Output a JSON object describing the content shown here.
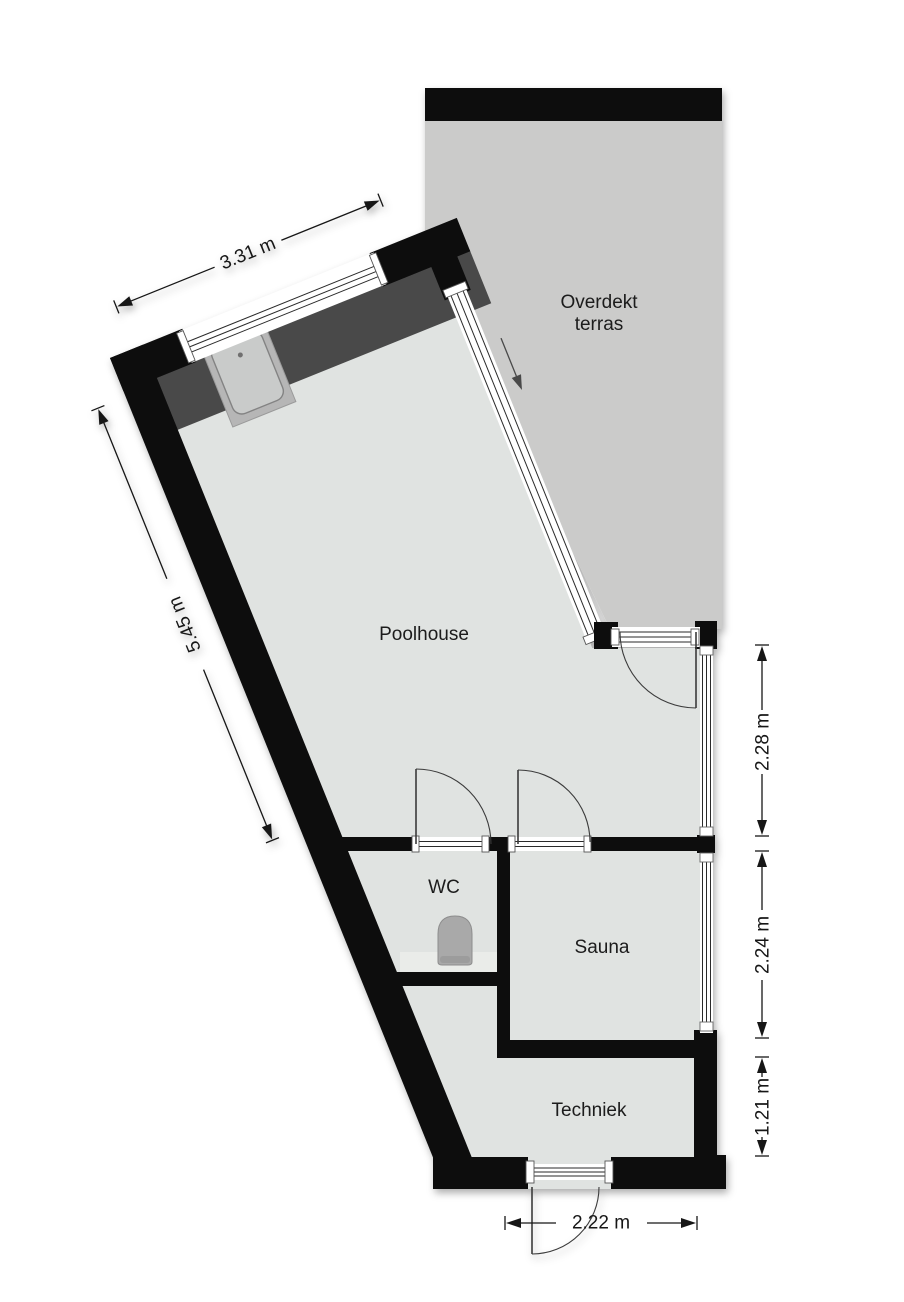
{
  "plan": {
    "type": "floorplan",
    "rooms": {
      "terrace": {
        "line1": "Overdekt",
        "line2": "terras"
      },
      "poolhouse": {
        "label": "Poolhouse"
      },
      "wc": {
        "label": "WC"
      },
      "sauna": {
        "label": "Sauna"
      },
      "techniek": {
        "label": "Techniek"
      }
    },
    "dimensions": {
      "window_top": "3.31 m",
      "left_wall": "5.45 m",
      "right_upper": "2.28 m",
      "right_middle": "2.24 m",
      "right_lower": "1.21 m",
      "bottom": "2.22 m"
    },
    "fixtures": [
      "sink-icon",
      "toilet-icon",
      "sliding-door-arrow-icon",
      "counter"
    ],
    "colors": {
      "wall": "#0b0b0b",
      "terrace_floor": "#cbcbca",
      "interior_floor": "#e0e3e1",
      "counter": "#484848",
      "sink_surround": "#b6b6b6",
      "toilet": "#a9a9a9",
      "dimension_text": "#161616"
    }
  }
}
